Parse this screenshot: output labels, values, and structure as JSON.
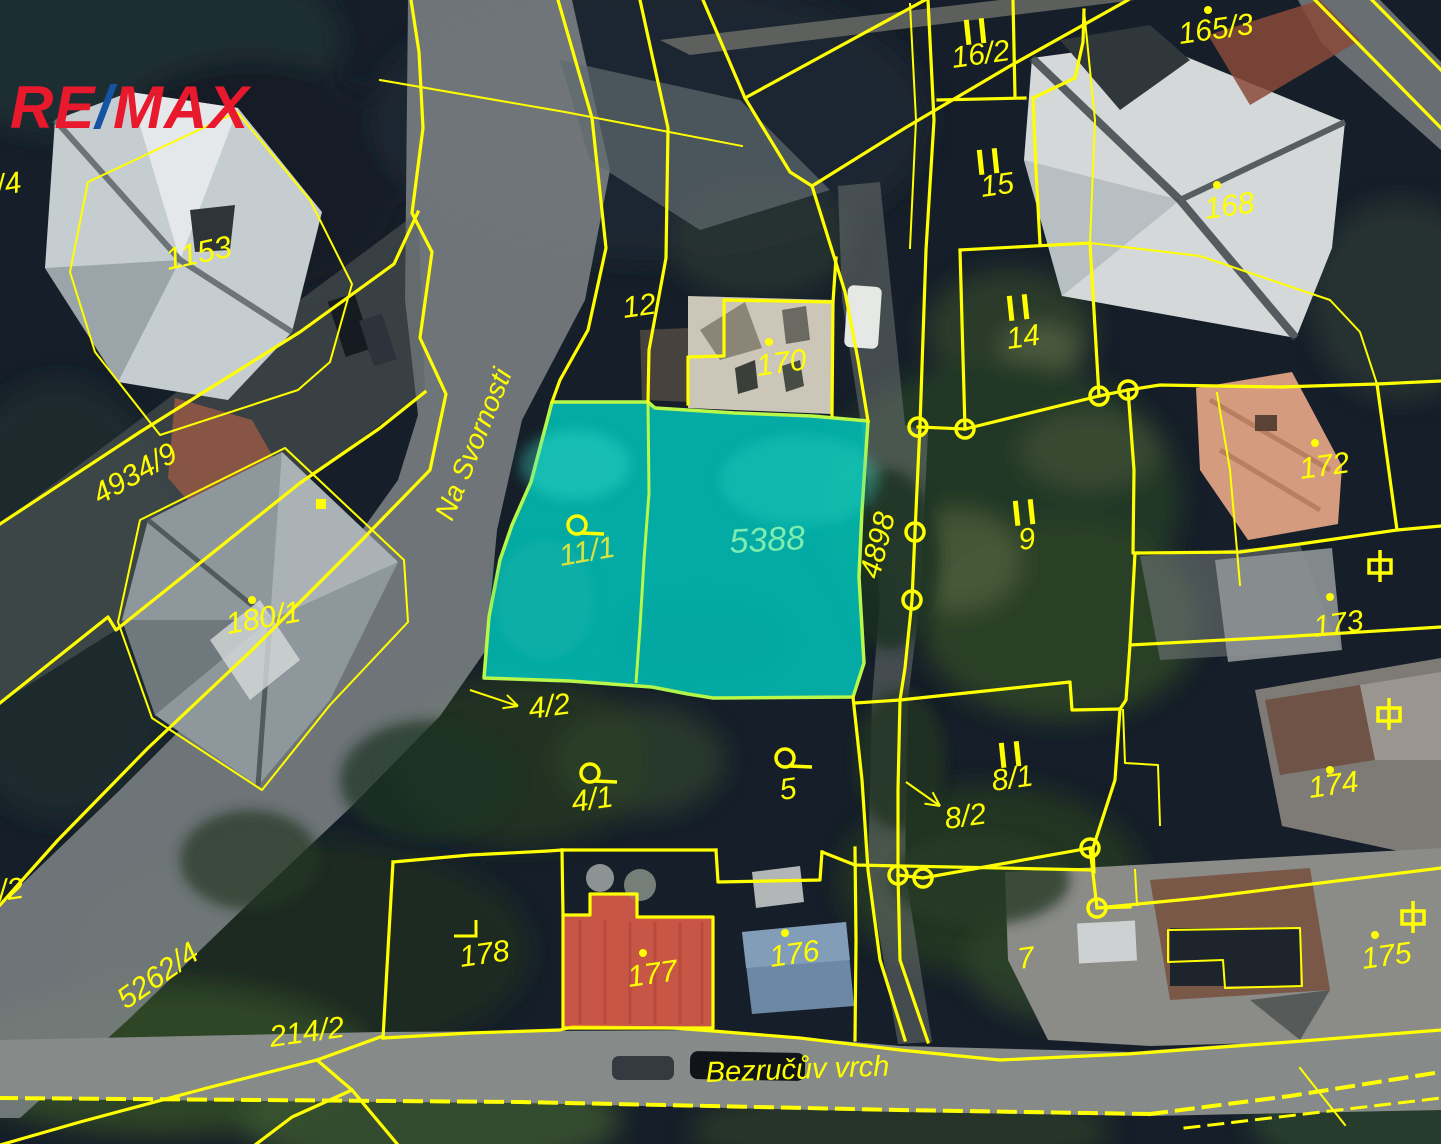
{
  "logo": {
    "part1": "RE",
    "slash": "/",
    "part2": "MAX",
    "color_red": "#e8192c",
    "color_blue": "#1553a5"
  },
  "map": {
    "colors": {
      "line": "#ffff00",
      "label": "#ffff00",
      "highlight_fill": "#00c9c0",
      "highlight_outline": "#b7f84b",
      "label_11_1": "#d7e43f",
      "label_5388": "#7dedaf"
    },
    "highlighted_parcels": [
      "11/1",
      "5388"
    ],
    "street_labels": [
      {
        "text": "Na Svornosti",
        "x": 452,
        "y": 522,
        "rot": -68,
        "size": 28
      },
      {
        "text": "Bezručův vrch",
        "x": 706,
        "y": 1082,
        "rot": -2,
        "size": 29
      }
    ],
    "parcel_labels": [
      {
        "text": "/4",
        "x": -2,
        "y": 196,
        "rot": -10,
        "size": 30
      },
      {
        "text": "1153",
        "x": 168,
        "y": 270,
        "rot": -12,
        "size": 31
      },
      {
        "text": "16/2",
        "x": 953,
        "y": 68,
        "rot": -8,
        "size": 30
      },
      {
        "text": "165/3",
        "x": 1180,
        "y": 44,
        "rot": -8,
        "size": 30
      },
      {
        "text": "15",
        "x": 982,
        "y": 197,
        "rot": -8,
        "size": 30
      },
      {
        "text": "168",
        "x": 1206,
        "y": 219,
        "rot": -8,
        "size": 30
      },
      {
        "text": "12",
        "x": 624,
        "y": 318,
        "rot": -8,
        "size": 30
      },
      {
        "text": "170",
        "x": 758,
        "y": 376,
        "rot": -8,
        "size": 30
      },
      {
        "text": "14",
        "x": 1008,
        "y": 349,
        "rot": -8,
        "size": 30
      },
      {
        "text": "4934/9",
        "x": 100,
        "y": 505,
        "rot": -30,
        "size": 30
      },
      {
        "text": "11/1",
        "x": 561,
        "y": 566,
        "rot": -10,
        "size": 30,
        "color": "#d7e43f"
      },
      {
        "text": "5388",
        "x": 730,
        "y": 553,
        "rot": -3,
        "size": 34,
        "color": "#7dedaf"
      },
      {
        "text": "4898",
        "x": 879,
        "y": 580,
        "rot": -76,
        "size": 30
      },
      {
        "text": "9",
        "x": 1020,
        "y": 550,
        "rot": -8,
        "size": 30
      },
      {
        "text": "172",
        "x": 1301,
        "y": 479,
        "rot": -8,
        "size": 30
      },
      {
        "text": "173",
        "x": 1315,
        "y": 637,
        "rot": -8,
        "size": 30
      },
      {
        "text": "180/1",
        "x": 228,
        "y": 634,
        "rot": -10,
        "size": 30
      },
      {
        "text": "4/2",
        "x": 530,
        "y": 719,
        "rot": -8,
        "size": 30
      },
      {
        "text": "4/1",
        "x": 573,
        "y": 812,
        "rot": -8,
        "size": 30
      },
      {
        "text": "5",
        "x": 781,
        "y": 800,
        "rot": -8,
        "size": 30
      },
      {
        "text": "8/1",
        "x": 993,
        "y": 791,
        "rot": -8,
        "size": 30
      },
      {
        "text": "8/2",
        "x": 946,
        "y": 829,
        "rot": -8,
        "size": 30
      },
      {
        "text": "174",
        "x": 1310,
        "y": 798,
        "rot": -8,
        "size": 30
      },
      {
        "text": "178",
        "x": 461,
        "y": 967,
        "rot": -8,
        "size": 30
      },
      {
        "text": "177",
        "x": 629,
        "y": 987,
        "rot": -8,
        "size": 30
      },
      {
        "text": "176",
        "x": 771,
        "y": 967,
        "rot": -8,
        "size": 30
      },
      {
        "text": "7",
        "x": 1019,
        "y": 969,
        "rot": -8,
        "size": 30
      },
      {
        "text": "175",
        "x": 1363,
        "y": 969,
        "rot": -8,
        "size": 30
      },
      {
        "text": "5262/4",
        "x": 126,
        "y": 1010,
        "rot": -35,
        "size": 30
      },
      {
        "text": "214/2",
        "x": 271,
        "y": 1047,
        "rot": -8,
        "size": 30
      },
      {
        "text": "/2",
        "x": 0,
        "y": 901,
        "rot": -8,
        "size": 30
      }
    ],
    "markers": {
      "dots": [
        [
          237,
          123
        ],
        [
          252,
          600
        ],
        [
          769,
          342
        ],
        [
          1208,
          10
        ],
        [
          1217,
          185
        ],
        [
          1315,
          443
        ],
        [
          1330,
          597
        ],
        [
          1330,
          770
        ],
        [
          643,
          953
        ],
        [
          785,
          933
        ],
        [
          1375,
          935
        ]
      ],
      "square_dots": [
        [
          321,
          504
        ]
      ],
      "survey_circles": [
        [
          918,
          427
        ],
        [
          965,
          429
        ],
        [
          1099,
          396
        ],
        [
          1128,
          390
        ],
        [
          915,
          532
        ],
        [
          912,
          600
        ],
        [
          898,
          875
        ],
        [
          923,
          878
        ],
        [
          1090,
          848
        ],
        [
          1097,
          908
        ]
      ],
      "double_bars": [
        [
          975,
          31
        ],
        [
          988,
          161
        ],
        [
          1018,
          307
        ],
        [
          1024,
          512
        ],
        [
          1010,
          754
        ]
      ],
      "circle_tails": [
        [
          577,
          525
        ],
        [
          590,
          773
        ],
        [
          785,
          758
        ]
      ],
      "ground_symbols": [
        [
          1380,
          566
        ],
        [
          1389,
          714
        ],
        [
          1413,
          917
        ]
      ],
      "corner_marks": [
        [
          476,
          920
        ]
      ]
    },
    "arrows": [
      {
        "x1": 470,
        "y1": 690,
        "x2": 518,
        "y2": 706
      },
      {
        "x1": 906,
        "y1": 782,
        "x2": 940,
        "y2": 806
      }
    ]
  }
}
